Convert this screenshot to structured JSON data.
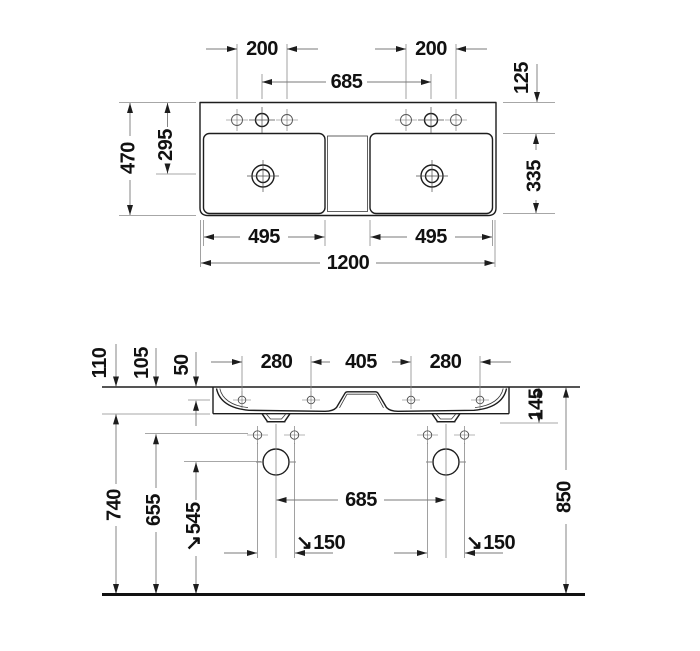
{
  "drawing": {
    "subject": "double-washbasin-technical-drawing",
    "background": "#ffffff",
    "object_line_color": "#1d1d1d",
    "dimension_line_color": "#787878",
    "text_color": "#111111",
    "top_view": {
      "dims": {
        "tap_spacing_left": "200",
        "tap_spacing_right": "200",
        "tap_center_distance": "685",
        "back_ledge_depth": "125",
        "overall_depth": "470",
        "drain_setback": "295",
        "bowl_inner_depth": "335",
        "bowl_width_left": "495",
        "bowl_width_right": "495",
        "overall_width": "1200"
      }
    },
    "front_view": {
      "leader_arrow": "↘",
      "dims": {
        "drop_outer": "110",
        "drop_inner": "105",
        "fixing_drop": "50",
        "fixing_spacing_left": "280",
        "fixing_spacing_center": "405",
        "fixing_spacing_right": "280",
        "outlet_drop": "145",
        "underside_height": "740",
        "supply_height": "655",
        "trap_height": "545",
        "drain_center_distance": "685",
        "supply_spacing_left": "150",
        "supply_spacing_right": "150",
        "rim_height": "850"
      }
    }
  }
}
